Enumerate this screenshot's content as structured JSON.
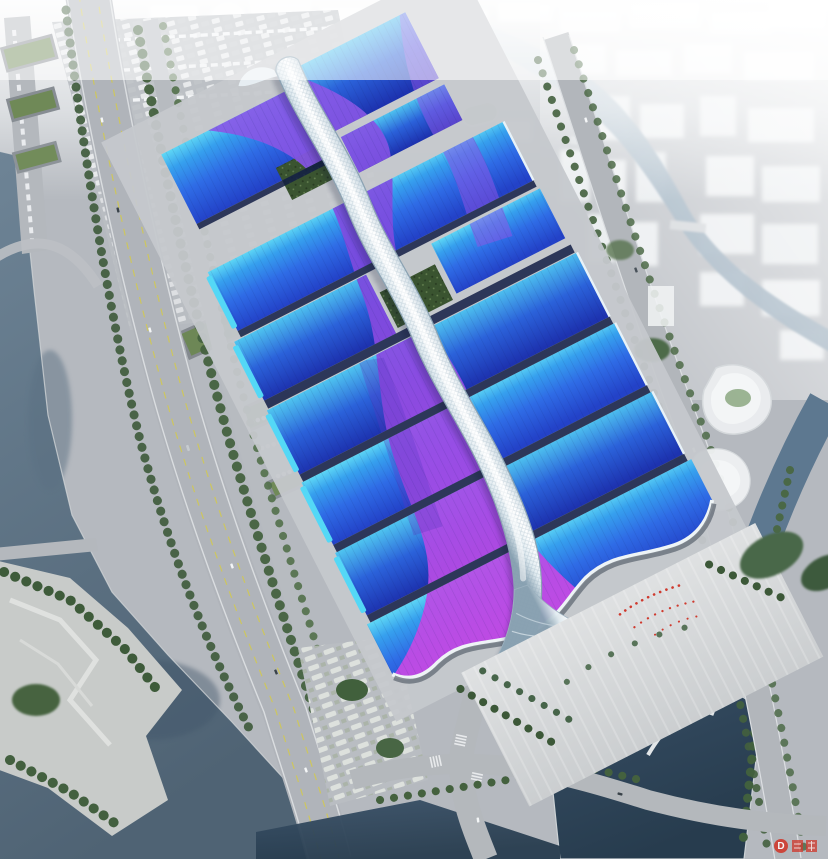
{
  "scene": {
    "kind": "aerial-architectural-rendering",
    "subject": "large exhibition and convention center with wavy blue roofs, purple ribbon graphics and a white serpentine central gallery, surrounded by hazy city, rivers, roads and parks"
  },
  "palette": {
    "ground": "#b5b9bf",
    "apron": "#c5c8cc",
    "plaza_light": "#dfe1e2",
    "plaza_dark": "#cbced0",
    "road": "#b2b6bb",
    "lane_yellow": "#d2c94f",
    "roof_cyan": "#5fd8f5",
    "roof_blue": "#2f6ce6",
    "roof_deep": "#2342c8",
    "roof_blue2": "#2b62da",
    "ribbon_violet": "#7b4ade",
    "ribbon_magenta": "#d04ae4",
    "spine_white": "#ffffff",
    "spine_shade": "#8aa2b2",
    "seam_navy": "#131e45",
    "water_river_light": "#6e8496",
    "water_river_dark": "#4f6374",
    "water_pond_light": "#3a5168",
    "water_pond_dark": "#273c4e",
    "water_canal": "#8aa0b2",
    "tree_green": "#45613f",
    "garden_green": "#3a5430",
    "haze_white": "#f7f8f9",
    "watermark_red": "#cf3a2e"
  },
  "watermark": {
    "logo_letter": "D"
  }
}
